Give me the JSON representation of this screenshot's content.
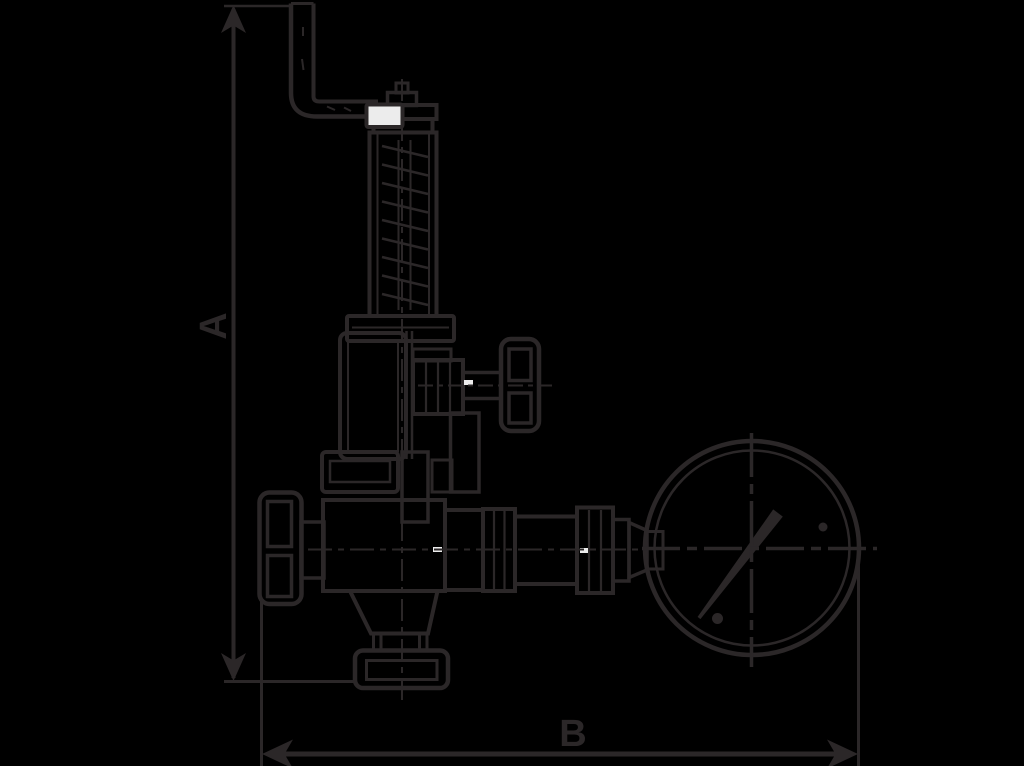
{
  "page": {
    "background_color": "#000000",
    "line_color": "#2b2728",
    "paper_highlight_color": "#ececec",
    "description": "Black-background technical line drawing of an angle safety valve with test lever, spring housing, shut-off handwheels, gauge piping and a round pressure gauge, annotated with overall dimension arrows."
  },
  "diagram": {
    "labels": {
      "dimension_vertical": "A",
      "dimension_horizontal": "B"
    }
  }
}
